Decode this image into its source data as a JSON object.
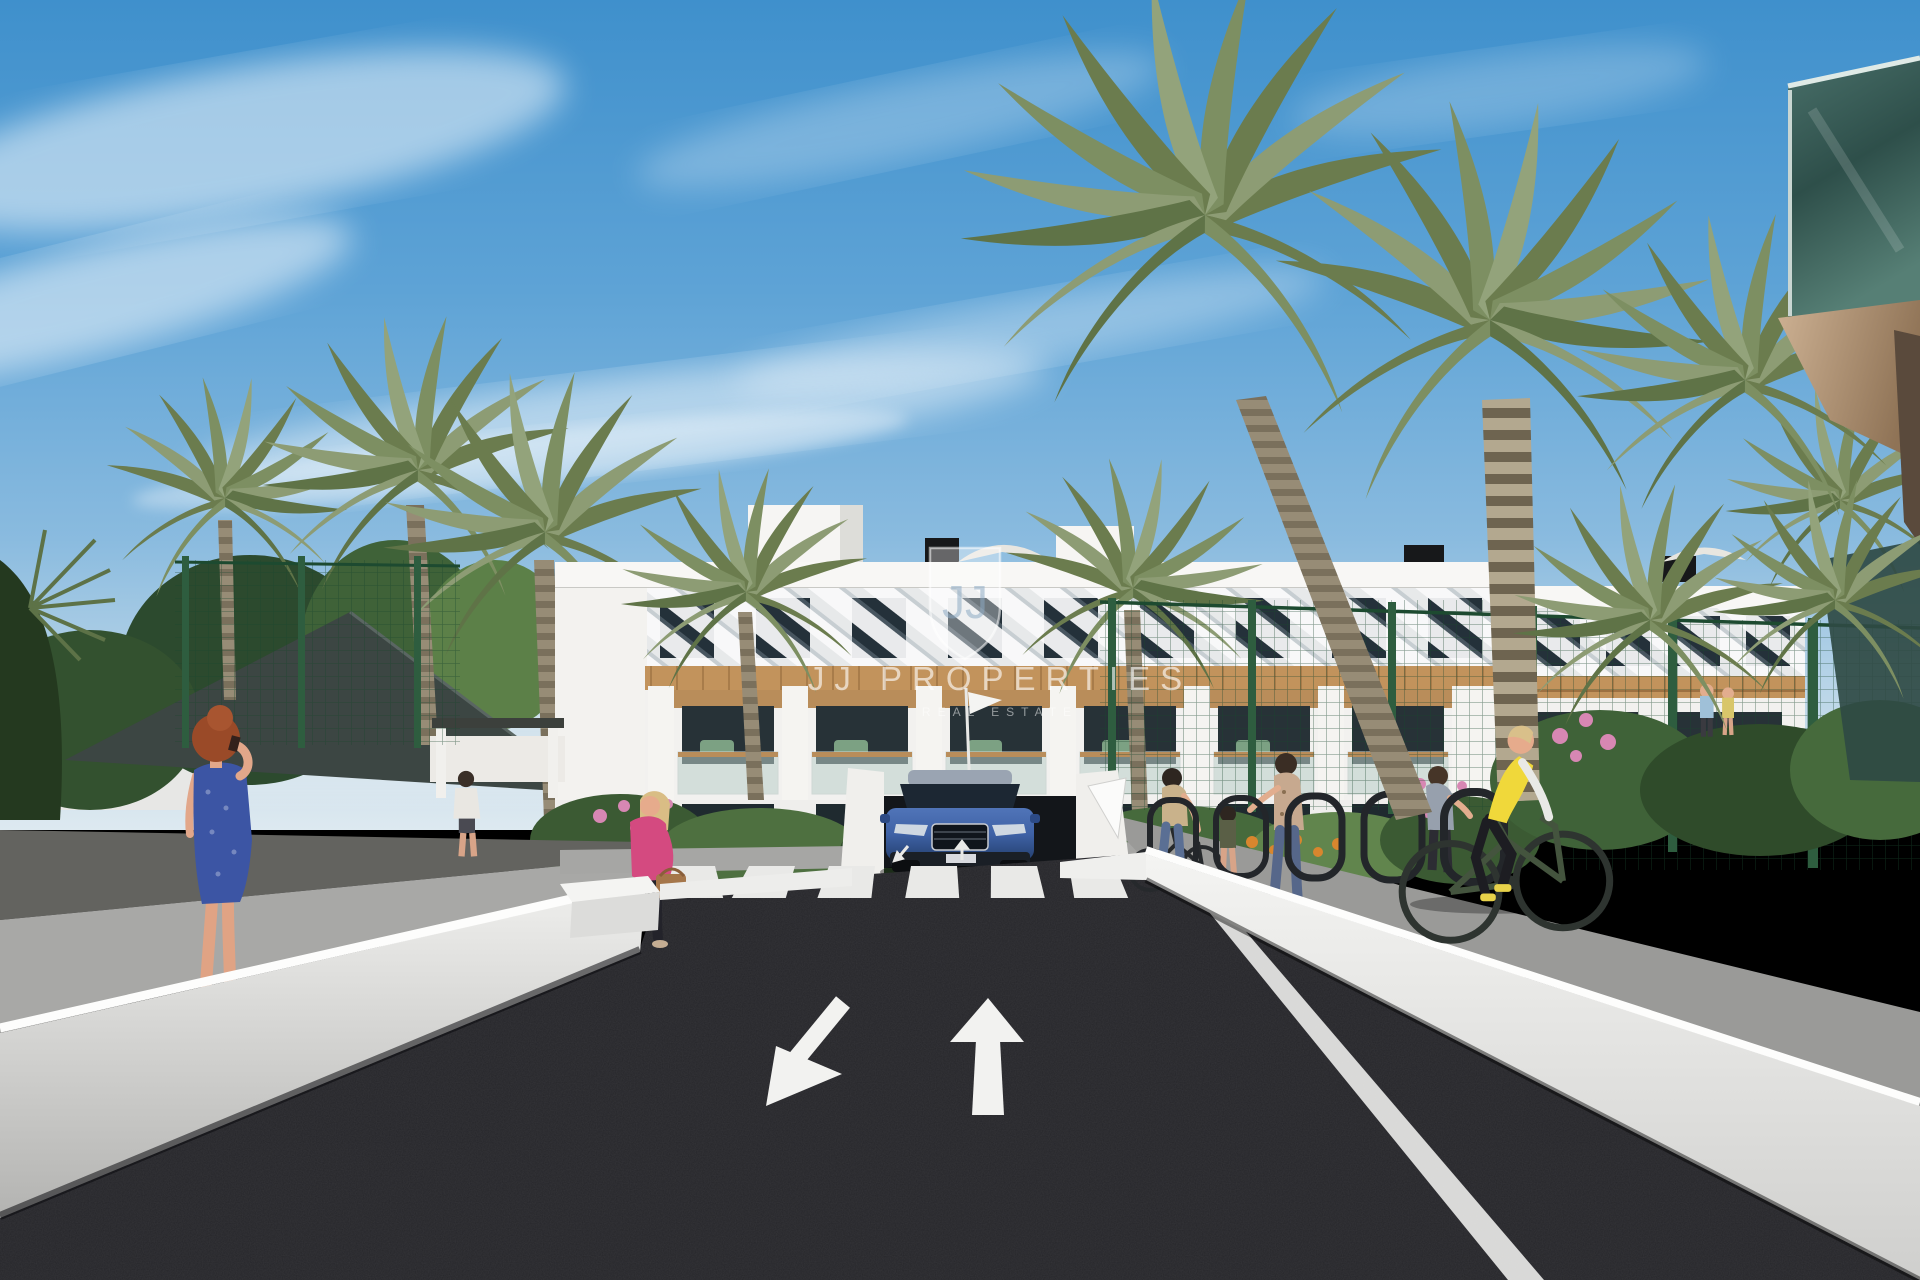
{
  "watermark": {
    "monogram": "JJ",
    "title": "JJ PROPERTIES",
    "subtitle": "REAL ESTATE"
  },
  "road_markings": {
    "lane_left": "down-left-arrow",
    "lane_right": "up-arrow"
  },
  "palette": {
    "sky_top": "#3f90cc",
    "sky_horizon": "#dde9f0",
    "asphalt": "#26262a",
    "wall_white": "#ececea",
    "wood_cladding": "#c2935c",
    "fence_green": "#2e5d3f",
    "palm_green": "#7d8f62",
    "hivis_yellow": "#f0d83a",
    "car_blue": "#3f62a6",
    "jacket_pink": "#d44a80",
    "dress_blue": "#3c55a4"
  }
}
